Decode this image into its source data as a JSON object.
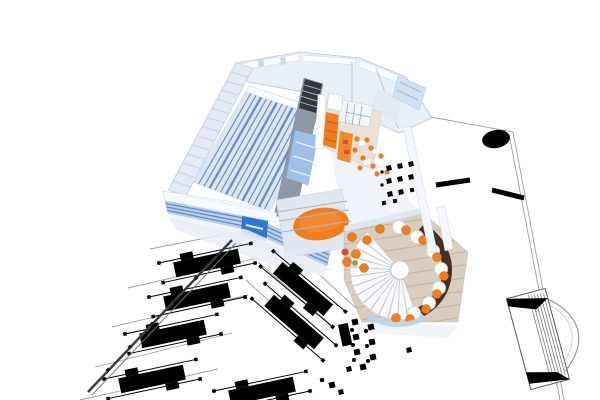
{
  "image": {
    "kind": "architectural-3d-floorplan-render",
    "width": 600,
    "height": 400
  },
  "colors": {
    "background": "#ffffff",
    "wall_white": "#f6f9fd",
    "wall_face": "#e9eff7",
    "wall_shadow": "#c9d6e7",
    "wall_edge": "#b7c6da",
    "roof_band": "#e3eaf3",
    "roof_slat": "#c4d2e2",
    "glass_band": "#b9cfe8",
    "glass_stripe": "#5e8cc8",
    "glazing_pane": "#cfe1f3",
    "sign_blue": "#2b76d8",
    "hall_floor": "#dce6f3",
    "hall_stripe": "#5c85c8",
    "corridor": "#8f98a8",
    "corridor_dark": "#31363f",
    "stair_tread": "#aab3c0",
    "kitchen_floor": "#e9e1d5",
    "accent_orange": "#ef7d1a",
    "accent_orange_light": "#f59340",
    "accent_red": "#d94b2a",
    "plant_green": "#7fae57",
    "cafe_floor": "#d8cdc0",
    "cafe_plank": "#c2b6a6",
    "bar_brown": "#46301f",
    "table_white": "#fcfcfb",
    "stair_white": "#fafbfc",
    "stair_edge": "#c9ccd2",
    "glass_arc": "#b8d4ee",
    "balcony_floor": "#e0e7f0",
    "railing": "#a8b6ca",
    "shadow_soft": "#e9eef5",
    "plan_black": "#000000",
    "plan_line": "#9aa0a8",
    "rail_dark": "#3a3f46"
  },
  "scene": {
    "regions": [
      "production-hall",
      "corridor",
      "kitchen",
      "dining-area",
      "cafe-bar",
      "spiral-staircase",
      "balcony-orange-rug",
      "front-facade",
      "2d-floorplan",
      "machine-rows",
      "stair-plan-symbol"
    ],
    "hall": {
      "A": [
        193,
        182
      ],
      "B": [
        249,
        86
      ],
      "C": [
        322,
        110
      ],
      "D": [
        270,
        211
      ],
      "stripes": 13
    },
    "roof_band": {
      "A": [
        236,
        63
      ],
      "B": [
        168,
        190
      ],
      "C": [
        253,
        68
      ],
      "D": [
        186,
        196
      ],
      "slats": 13
    },
    "facade_stripes": {
      "top": [
        [
          165,
          201
        ],
        [
          250,
          216
        ],
        [
          330,
          252
        ]
      ],
      "bottom": [
        [
          168,
          213
        ],
        [
          248,
          230
        ],
        [
          327,
          266
        ]
      ],
      "fractions": [
        0.22,
        0.5,
        0.78
      ]
    },
    "corridor": {
      "treads": {
        "T1": [
          305,
          79
        ],
        "T2": [
          322,
          84
        ],
        "B1": [
          299,
          108
        ],
        "B2": [
          316,
          113
        ],
        "count": 4
      },
      "cross": {
        "L1": [
          304,
          78
        ],
        "L2": [
          272,
          225
        ],
        "R1": [
          323,
          84
        ],
        "R2": [
          292,
          231
        ],
        "fractions": [
          0.38,
          0.52,
          0.66,
          0.82
        ]
      }
    },
    "railings": [
      [
        277,
        212,
        347,
        201
      ],
      [
        279,
        221,
        349,
        210
      ],
      [
        282,
        232,
        351,
        221
      ]
    ],
    "spiral_stair": {
      "cx": 400,
      "cy": 270,
      "r1": 10,
      "r2": 50,
      "start": 70,
      "end": 230,
      "steps": 14
    },
    "planks": {
      "x1": 340,
      "x2": 470,
      "yStart": 220,
      "dy": 13,
      "rise": 20,
      "count": 9
    },
    "cafe_tables": [
      [
        417,
        237
      ],
      [
        433,
        251
      ],
      [
        441,
        269
      ],
      [
        439,
        288
      ],
      [
        429,
        303
      ],
      [
        414,
        313
      ],
      [
        399,
        227
      ]
    ],
    "cafe_stools": [
      [
        406,
        230
      ],
      [
        423,
        240
      ],
      [
        437,
        257
      ],
      [
        444,
        276
      ],
      [
        437,
        294
      ],
      [
        426,
        309
      ],
      [
        410,
        319
      ],
      [
        396,
        318
      ],
      [
        367,
        240
      ],
      [
        356,
        254
      ],
      [
        364,
        268
      ],
      [
        352,
        237
      ],
      [
        380,
        229
      ],
      [
        347,
        262
      ]
    ],
    "extra_items": {
      "red": [
        345,
        252
      ],
      "green": [
        355,
        263
      ]
    },
    "dining_tables": [
      [
        362,
        143
      ],
      [
        376,
        151
      ],
      [
        367,
        162
      ],
      [
        381,
        170
      ]
    ],
    "dining_chairs": [
      [
        357,
        139
      ],
      [
        367,
        140
      ],
      [
        371,
        148
      ],
      [
        381,
        156
      ],
      [
        363,
        158
      ],
      [
        373,
        166
      ],
      [
        377,
        174
      ],
      [
        387,
        172
      ],
      [
        355,
        150
      ],
      [
        360,
        168
      ]
    ],
    "island_grid": [
      [
        348,
        103,
        345,
        124
      ],
      [
        355,
        104,
        352,
        125
      ],
      [
        362,
        106,
        359,
        126
      ],
      [
        345,
        112,
        370,
        117
      ]
    ],
    "machine_shape": {
      "body": [
        66,
        15
      ],
      "tab": [
        13,
        7
      ],
      "foot": 3.5,
      "axle": 47
    },
    "machines": [
      [
        207,
        263,
        -12
      ],
      [
        197,
        297,
        -12
      ],
      [
        173,
        334,
        -12
      ],
      [
        152,
        379,
        -12
      ],
      [
        303,
        289,
        40
      ],
      [
        294,
        322,
        41
      ],
      [
        262,
        391,
        -12
      ]
    ],
    "plan_squares": [
      [
        389,
        168,
        5
      ],
      [
        400,
        166,
        5
      ],
      [
        411,
        164,
        5
      ],
      [
        389,
        181,
        5
      ],
      [
        400,
        179,
        5
      ],
      [
        411,
        177,
        5
      ],
      [
        390,
        194,
        5
      ],
      [
        401,
        192,
        5
      ],
      [
        412,
        190,
        4
      ],
      [
        384,
        203,
        4
      ],
      [
        395,
        201,
        4
      ],
      [
        382,
        172,
        3
      ],
      [
        382,
        185,
        3
      ],
      [
        355,
        322,
        6
      ],
      [
        356,
        337,
        6
      ],
      [
        357,
        352,
        6
      ],
      [
        363,
        367,
        6
      ],
      [
        371,
        327,
        6
      ],
      [
        372,
        342,
        6
      ],
      [
        373,
        357,
        6
      ],
      [
        349,
        369,
        5
      ],
      [
        409,
        350,
        5
      ],
      [
        332,
        385,
        6
      ],
      [
        341,
        392,
        5
      ],
      [
        322,
        380,
        4
      ]
    ],
    "plan_rects": [
      [
        338,
        325,
        10,
        22
      ]
    ],
    "plan_dots": [
      [
        352,
        330
      ],
      [
        353,
        345
      ],
      [
        354,
        360
      ],
      [
        366,
        331
      ],
      [
        367,
        346
      ],
      [
        368,
        361
      ]
    ],
    "wall_segments": [
      [
        436,
        185,
        470,
        180,
        5
      ],
      [
        492,
        190,
        524,
        198,
        5
      ]
    ],
    "lane_lines": [
      [
        150,
        249,
        262,
        227
      ],
      [
        128,
        288,
        258,
        258
      ],
      [
        112,
        327,
        248,
        295
      ],
      [
        95,
        367,
        232,
        333
      ],
      [
        80,
        400,
        218,
        369
      ],
      [
        258,
        262,
        332,
        326
      ],
      [
        288,
        246,
        356,
        308
      ],
      [
        246,
        280,
        318,
        345
      ]
    ],
    "boundary_lines": [
      [
        420,
        115,
        513,
        132
      ],
      [
        513,
        132,
        564,
        400
      ],
      [
        509,
        134,
        560,
        400
      ]
    ],
    "rail": {
      "line": [
        232,
        240,
        88,
        392
      ],
      "line2": [
        236,
        243,
        92,
        395
      ],
      "dots": [
        [
          218,
          255
        ],
        [
          196,
          278
        ],
        [
          174,
          301
        ],
        [
          152,
          324
        ],
        [
          130,
          347
        ],
        [
          108,
          370
        ]
      ]
    },
    "plan_ellipse": {
      "cx": 496,
      "cy": 139,
      "rx": 14,
      "ry": 9,
      "rot": -10
    },
    "stair_symbol": {
      "x": 538,
      "y": 339,
      "rot": -15
    }
  }
}
